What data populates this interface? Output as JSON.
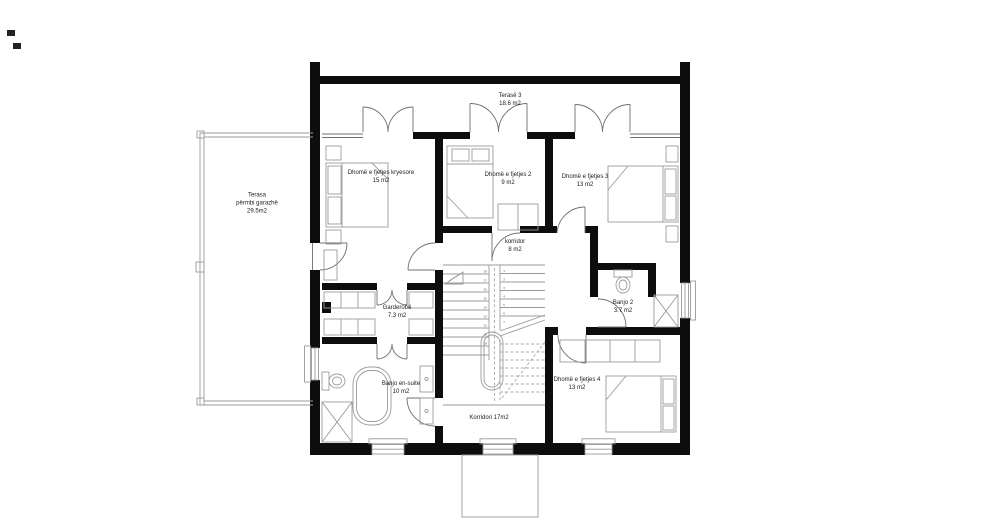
{
  "drawing": {
    "type": "architectural-floor-plan",
    "floor": "upper floor"
  },
  "rooms": {
    "terasa3": {
      "name": "Terasë 3",
      "area": "18.6 m2"
    },
    "master": {
      "name": "Dhomë e fjetjes kryesore",
      "area": "15 m2"
    },
    "bedroom2": {
      "name": "Dhomë e fjetjes 2",
      "area": "9 m2"
    },
    "bedroom3": {
      "name": "Dhomë e fjetjes 3",
      "area": "13 m2"
    },
    "terasa_garazhe": {
      "name": "Terasa",
      "sub": "përmbi garazhë",
      "area": "29.5m2"
    },
    "korridor": {
      "name": "korridor",
      "area": "8 m2"
    },
    "garderobe": {
      "name": "Garderobë",
      "area": "7.3 m2"
    },
    "banjo2": {
      "name": "Banjo 2",
      "area": "3.7 m2"
    },
    "banjo_ensuite": {
      "name": "Banjo en-suite",
      "area": "10 m2"
    },
    "bedroom4": {
      "name": "Dhomë e fjetjes 4",
      "area": "13 m2"
    },
    "korridori": {
      "name": "Korridori 17m2"
    }
  },
  "stairs": {
    "left": [
      "18",
      "17",
      "16",
      "15",
      "14",
      "13",
      "12",
      "11",
      "10"
    ],
    "right": [
      "1",
      "2",
      "3",
      "4",
      "5",
      "6",
      "7"
    ]
  },
  "colors": {
    "wall": "#0d0d0d",
    "furniture_line": "#9b9b9b",
    "glazing_line": "#6f6f6f",
    "label_text": "#1b1b1b",
    "background": "#ffffff"
  }
}
